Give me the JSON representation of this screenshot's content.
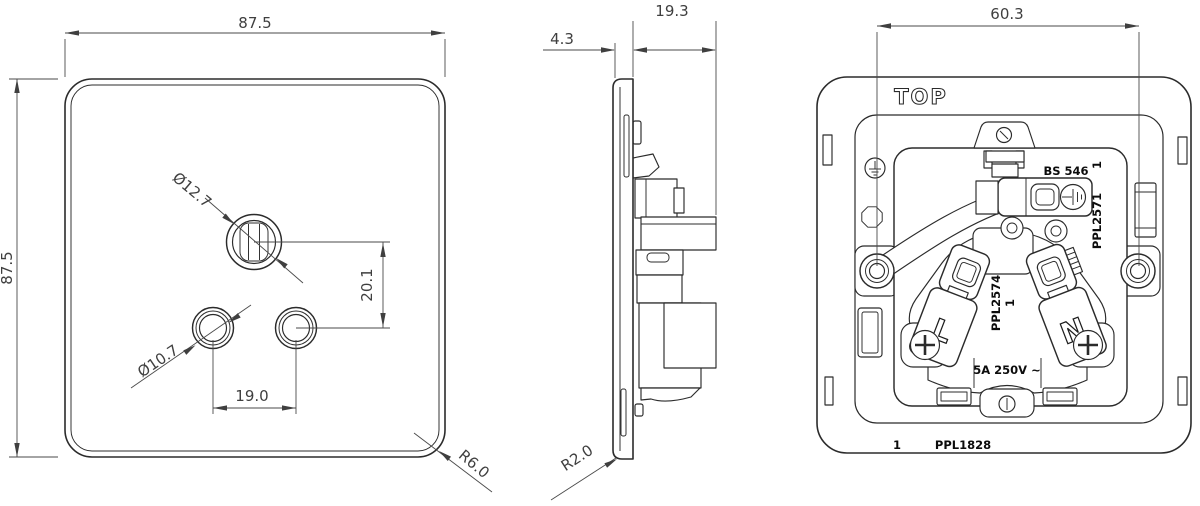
{
  "drawing": {
    "front_view": {
      "dim_width": "87.5",
      "dim_height": "87.5",
      "dim_earth_pin_hole_dia": "Ø12.7",
      "dim_line_pin_hole_dia": "Ø10.7",
      "dim_pin_spacing_horizontal": "19.0",
      "dim_pin_spacing_vertical": "20.1",
      "dim_corner_radius": "R6.0"
    },
    "side_view": {
      "dim_plate_thickness": "4.3",
      "dim_mechanism_depth": "19.3",
      "dim_edge_radius": "R2.0"
    },
    "rear_view": {
      "dim_fixing_centres": "60.3",
      "orientation_label": "TOP",
      "standard_label": "BS 546",
      "part_number_insert": "PPL2571",
      "part_number_insert_issue": "1",
      "part_number_carrier": "PPL2574",
      "part_number_carrier_issue": "1",
      "rating_label": "5A 250V ~",
      "live_terminal_label": "L",
      "neutral_terminal_label": "N",
      "footer_issue": "1",
      "footer_part_number": "PPL1828"
    }
  }
}
